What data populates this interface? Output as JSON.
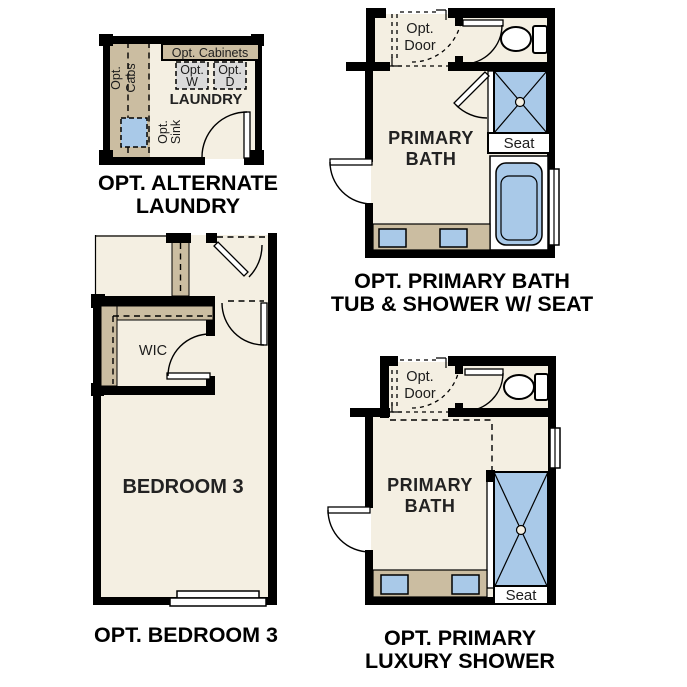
{
  "page": {
    "background": "#ffffff",
    "description_title": "Floor plan options sheet"
  },
  "colors": {
    "wall": "#000000",
    "room_fill": "#f4efe2",
    "cabinet_tan": "#cbbda1",
    "fixture_blue": "#a9c9e8",
    "appliance_gray": "#dbdbdb",
    "caption_text": "#000000"
  },
  "plans": {
    "laundry": {
      "caption": [
        "OPT. ALTERNATE",
        "LAUNDRY"
      ],
      "room_label": "LAUNDRY",
      "opt_cabinets_label": "Opt. Cabinets",
      "opt_washer_label": [
        "Opt.",
        "W"
      ],
      "opt_dryer_label": [
        "Opt.",
        "D"
      ],
      "opt_cabs_label": [
        "Opt.",
        "Cabs"
      ],
      "opt_sink_label": [
        "Opt.",
        "Sink"
      ]
    },
    "primary_bath_tub_shower": {
      "caption": [
        "OPT. PRIMARY BATH",
        "TUB & SHOWER W/ SEAT"
      ],
      "room_label": [
        "PRIMARY",
        "BATH"
      ],
      "opt_door_label": [
        "Opt.",
        "Door"
      ],
      "seat_label": "Seat"
    },
    "bedroom3": {
      "caption": [
        "OPT. BEDROOM 3"
      ],
      "room_label": "BEDROOM 3",
      "wic_label": "WIC"
    },
    "primary_luxury_shower": {
      "caption": [
        "OPT. PRIMARY",
        "LUXURY SHOWER"
      ],
      "room_label": [
        "PRIMARY",
        "BATH"
      ],
      "opt_door_label": [
        "Opt.",
        "Door"
      ],
      "seat_label": "Seat"
    }
  }
}
